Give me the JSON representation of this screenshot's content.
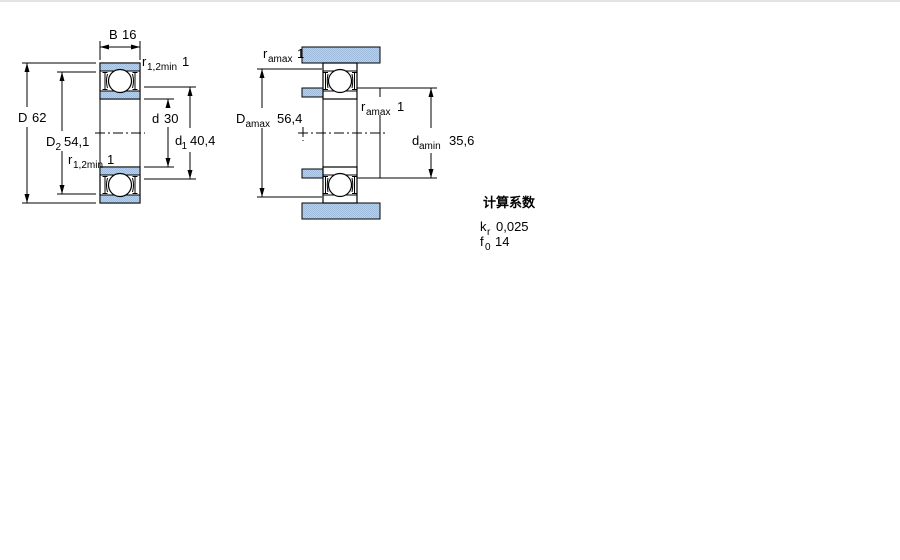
{
  "page": {
    "top_border_color": "#c9c9c9"
  },
  "colors": {
    "section_fill_light": "#bad0e8",
    "section_fill_dark": "#9fbcdc",
    "line_color": "#000000"
  },
  "left_view": {
    "width": {
      "symbol": "B",
      "value": "16"
    },
    "outer_diameter": {
      "symbol": "D",
      "value": "62"
    },
    "recess_diameter": {
      "symbol": "D",
      "subscript": "2",
      "value": "54,1"
    },
    "bore_diameter": {
      "symbol": "d",
      "value": "30"
    },
    "shoulder_diameter": {
      "symbol": "d",
      "subscript": "1",
      "value": "40,4"
    },
    "fillet_top": {
      "symbol": "r",
      "subscript": "1,2min",
      "value": "1"
    },
    "fillet_bottom": {
      "symbol": "r",
      "subscript": "1,2min",
      "value": "1"
    }
  },
  "right_view": {
    "fillet_housing": {
      "symbol": "r",
      "subscript": "amax",
      "value": "1"
    },
    "housing_abutment_diameter": {
      "symbol": "D",
      "subscript": "amax",
      "value": "56,4"
    },
    "fillet_shaft": {
      "symbol": "r",
      "subscript": "amax",
      "value": "1"
    },
    "shaft_abutment_diameter": {
      "symbol": "d",
      "subscript": "amin",
      "value": "35,6"
    }
  },
  "calculation_factors": {
    "heading": "计算系数",
    "factors": [
      {
        "symbol": "k",
        "subscript": "r",
        "value": "0,025"
      },
      {
        "symbol": "f",
        "subscript": "0",
        "value": "14"
      }
    ]
  }
}
